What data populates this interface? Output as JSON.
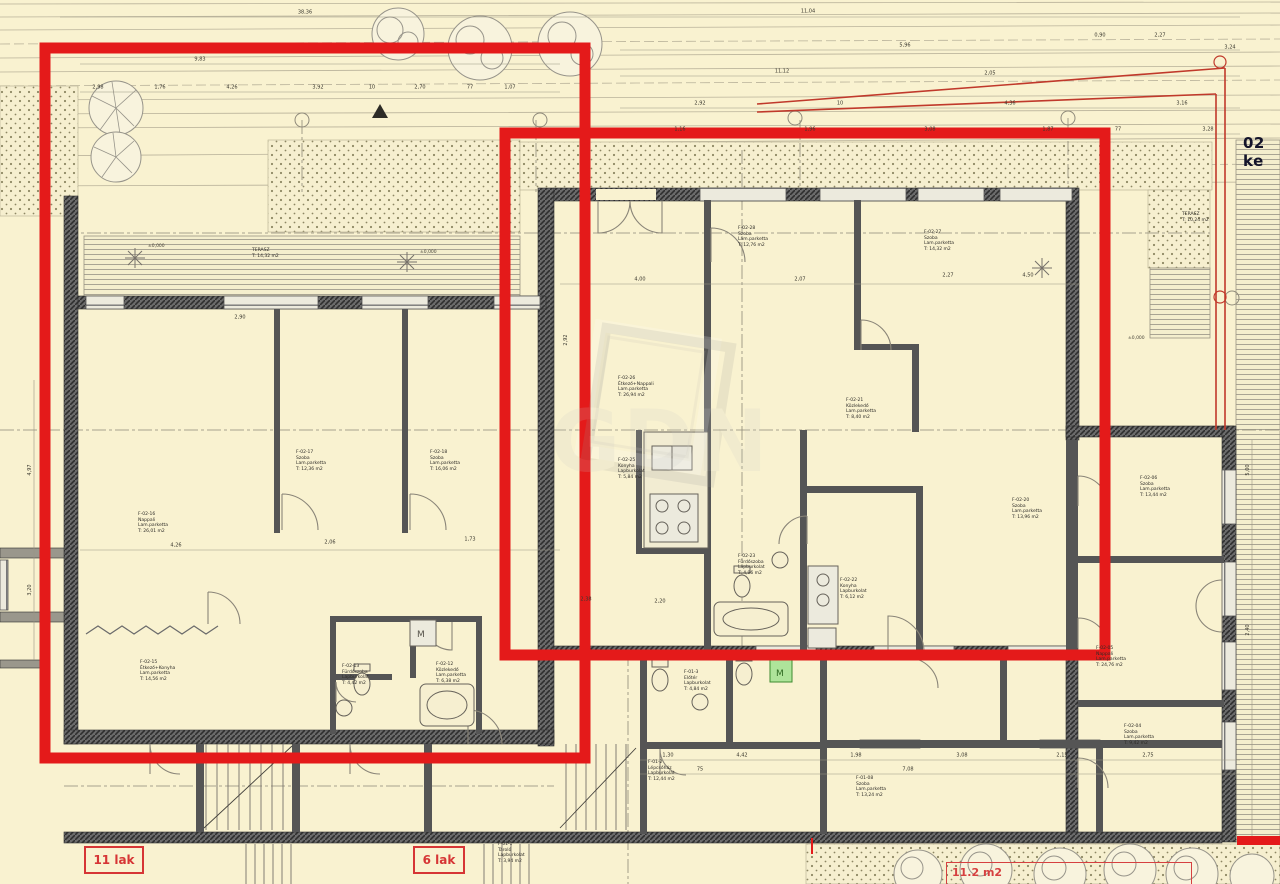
{
  "side_text": "02 ke",
  "unit_labels": {
    "left": "11 lak",
    "mid": "6 lak",
    "area": "11.2 m2"
  },
  "watermark": "GDN",
  "colors": {
    "background": "#f9f2d0",
    "red_overlay": "#e41a1a",
    "red_label": "#d63535",
    "wall": "#4b4b4b",
    "green_box": "#aee49a"
  },
  "rooms": [
    {
      "x": 138,
      "y": 512,
      "l": [
        "F-02-16",
        "Nappali",
        "Lam.parketta",
        "T:   26,01 m2"
      ]
    },
    {
      "x": 296,
      "y": 450,
      "l": [
        "F-02-17",
        "Szoba",
        "Lam.parketta",
        "T:   12,36 m2"
      ]
    },
    {
      "x": 430,
      "y": 450,
      "l": [
        "F-02-18",
        "Szoba",
        "Lam.parketta",
        "T:   16,06 m2"
      ]
    },
    {
      "x": 140,
      "y": 660,
      "l": [
        "F-02-15",
        "Étkező+Konyha",
        "Lam.parketta",
        "T:   14,56 m2"
      ]
    },
    {
      "x": 342,
      "y": 664,
      "l": [
        "F-02-13",
        "Fürdőszoba",
        "Lapburkolat",
        "T:   4,42 m2"
      ]
    },
    {
      "x": 436,
      "y": 662,
      "l": [
        "F-02-12",
        "Közlekedő",
        "Lam.parketta",
        "T:   6,38 m2"
      ]
    },
    {
      "x": 618,
      "y": 376,
      "l": [
        "F-02-26",
        "Étkező+Nappali",
        "Lam.parketta",
        "T:   26,94 m2"
      ]
    },
    {
      "x": 738,
      "y": 226,
      "l": [
        "F-02-28",
        "Szoba",
        "Lam.parketta",
        "T:   12,76 m2"
      ]
    },
    {
      "x": 924,
      "y": 230,
      "l": [
        "F-02-27",
        "Szoba",
        "Lam.parketta",
        "T:   14,32 m2"
      ]
    },
    {
      "x": 618,
      "y": 458,
      "l": [
        "F-02-25",
        "Konyha",
        "Lapburkolat",
        "T:   5,84 m2"
      ]
    },
    {
      "x": 738,
      "y": 554,
      "l": [
        "F-02-23",
        "Fürdőszoba",
        "Lapburkolat",
        "T:   4,96 m2"
      ]
    },
    {
      "x": 840,
      "y": 578,
      "l": [
        "F-02-22",
        "Konyha",
        "Lapburkolat",
        "T:   6,12 m2"
      ]
    },
    {
      "x": 846,
      "y": 398,
      "l": [
        "F-02-21",
        "Közlekedő",
        "Lam.parketta",
        "T:   8,40 m2"
      ]
    },
    {
      "x": 1012,
      "y": 498,
      "l": [
        "F-02-20",
        "Szoba",
        "Lam.parketta",
        "T:   13,96 m2"
      ]
    },
    {
      "x": 1140,
      "y": 476,
      "l": [
        "F-02-06",
        "Szoba",
        "Lam.parketta",
        "T:   13,44 m2"
      ]
    },
    {
      "x": 1096,
      "y": 646,
      "l": [
        "F-02-05",
        "Nappali",
        "Lam.parketta",
        "T:   24,76 m2"
      ]
    },
    {
      "x": 1124,
      "y": 724,
      "l": [
        "F-02-04",
        "Szoba",
        "Lam.parketta",
        "T:   9,42 m2"
      ]
    },
    {
      "x": 648,
      "y": 760,
      "l": [
        "F-01-2",
        "Lépcsőház",
        "Lapburkolat",
        "T:   12,44 m2"
      ]
    },
    {
      "x": 684,
      "y": 670,
      "l": [
        "F-01-3",
        "Előtér",
        "Lapburkolat",
        "T:   4,84 m2"
      ]
    },
    {
      "x": 856,
      "y": 776,
      "l": [
        "F-01-08",
        "Szoba",
        "Lam.parketta",
        "T:   13,24 m2"
      ]
    },
    {
      "x": 498,
      "y": 842,
      "l": [
        "F-01-1",
        "Tároló",
        "Lapburkolat",
        "T:   3,94 m2"
      ]
    },
    {
      "x": 252,
      "y": 248,
      "l": [
        "TERASZ",
        "T:   14,32 m2"
      ]
    },
    {
      "x": 1182,
      "y": 212,
      "l": [
        "TERASZ",
        "T:   10,24 m2"
      ]
    }
  ],
  "dims": [
    {
      "x": 305,
      "y": 13,
      "t": "38,36"
    },
    {
      "x": 200,
      "y": 60,
      "t": "9,83"
    },
    {
      "x": 98,
      "y": 88,
      "t": "2,98"
    },
    {
      "x": 160,
      "y": 88,
      "t": "1,76"
    },
    {
      "x": 232,
      "y": 88,
      "t": "4,26"
    },
    {
      "x": 318,
      "y": 88,
      "t": "3,92"
    },
    {
      "x": 372,
      "y": 88,
      "t": "10"
    },
    {
      "x": 420,
      "y": 88,
      "t": "2,70"
    },
    {
      "x": 470,
      "y": 88,
      "t": "77"
    },
    {
      "x": 510,
      "y": 88,
      "t": "1,07"
    },
    {
      "x": 808,
      "y": 12,
      "t": "11,04"
    },
    {
      "x": 1100,
      "y": 36,
      "t": "0,90"
    },
    {
      "x": 1160,
      "y": 36,
      "t": "2,27"
    },
    {
      "x": 905,
      "y": 46,
      "t": "5,96"
    },
    {
      "x": 1230,
      "y": 48,
      "t": "3,24"
    },
    {
      "x": 782,
      "y": 72,
      "t": "11,12"
    },
    {
      "x": 990,
      "y": 74,
      "t": "2,05"
    },
    {
      "x": 700,
      "y": 104,
      "t": "2,92"
    },
    {
      "x": 840,
      "y": 104,
      "t": "10"
    },
    {
      "x": 1010,
      "y": 104,
      "t": "4,36"
    },
    {
      "x": 1182,
      "y": 104,
      "t": "3,16"
    },
    {
      "x": 680,
      "y": 130,
      "t": "1,16"
    },
    {
      "x": 810,
      "y": 130,
      "t": "1,96"
    },
    {
      "x": 930,
      "y": 130,
      "t": "3,08"
    },
    {
      "x": 1048,
      "y": 130,
      "t": "1,87"
    },
    {
      "x": 1118,
      "y": 130,
      "t": "77"
    },
    {
      "x": 1208,
      "y": 130,
      "t": "3,28"
    },
    {
      "x": 640,
      "y": 280,
      "t": "4,00"
    },
    {
      "x": 800,
      "y": 280,
      "t": "2,07"
    },
    {
      "x": 948,
      "y": 276,
      "t": "2,27"
    },
    {
      "x": 1028,
      "y": 276,
      "t": "4,50"
    },
    {
      "x": 240,
      "y": 318,
      "t": "2,90"
    },
    {
      "x": 176,
      "y": 546,
      "t": "4,26"
    },
    {
      "x": 330,
      "y": 543,
      "t": "2,06"
    },
    {
      "x": 470,
      "y": 540,
      "t": "1,73"
    },
    {
      "x": 586,
      "y": 600,
      "t": "2,38"
    },
    {
      "x": 660,
      "y": 602,
      "t": "2,20"
    },
    {
      "x": 668,
      "y": 756,
      "t": "1,30"
    },
    {
      "x": 742,
      "y": 756,
      "t": "4,42"
    },
    {
      "x": 856,
      "y": 756,
      "t": "1,98"
    },
    {
      "x": 962,
      "y": 756,
      "t": "3,08"
    },
    {
      "x": 1062,
      "y": 756,
      "t": "2,15"
    },
    {
      "x": 1148,
      "y": 756,
      "t": "2,75"
    },
    {
      "x": 700,
      "y": 770,
      "t": "75"
    },
    {
      "x": 908,
      "y": 770,
      "t": "7,08"
    },
    {
      "x": 1248,
      "y": 470,
      "t": "5,00",
      "r": 1
    },
    {
      "x": 1248,
      "y": 630,
      "t": "2,40",
      "r": 1
    },
    {
      "x": 30,
      "y": 470,
      "t": "4,97",
      "r": 1
    },
    {
      "x": 30,
      "y": 590,
      "t": "3,20",
      "r": 1
    },
    {
      "x": 566,
      "y": 340,
      "t": "2,92",
      "r": 1
    }
  ],
  "elevation_marks": [
    {
      "x": 148,
      "y": 244,
      "t": "±0,000"
    },
    {
      "x": 420,
      "y": 250,
      "t": "±0,000"
    },
    {
      "x": 1128,
      "y": 336,
      "t": "±0,000"
    }
  ],
  "fixture_labels": {
    "machine": "M",
    "machine_green": "M"
  }
}
